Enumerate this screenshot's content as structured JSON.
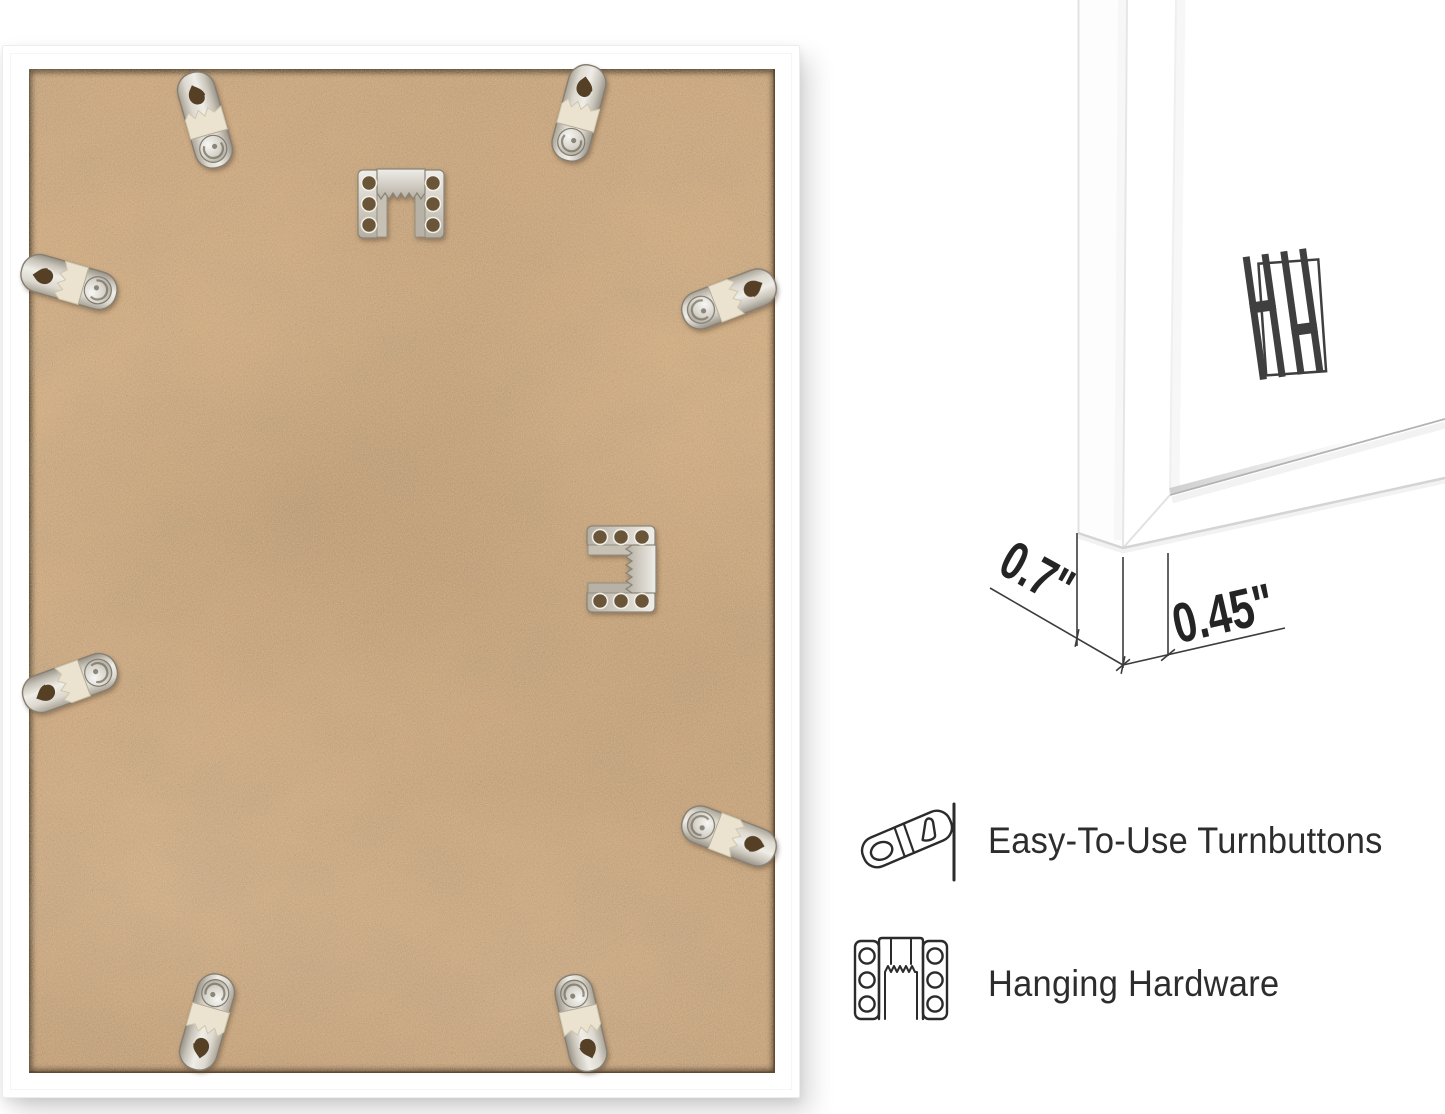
{
  "canvas": {
    "background": "#ffffff"
  },
  "frame_back_photo": {
    "frame_color": "#ffffff",
    "backing_color": "#c9a57e",
    "turnbutton_count": 8,
    "sawtooth_hanger_count": 2
  },
  "corner_detail": {
    "brand_logo": "HH",
    "dimensions": {
      "side_depth": "0.7\"",
      "moulding_width": "0.45\""
    }
  },
  "features": [
    {
      "icon": "turnbutton-icon",
      "label": "Easy-To-Use Turnbuttons"
    },
    {
      "icon": "sawtooth-hanger-icon",
      "label": "Hanging Hardware"
    }
  ]
}
